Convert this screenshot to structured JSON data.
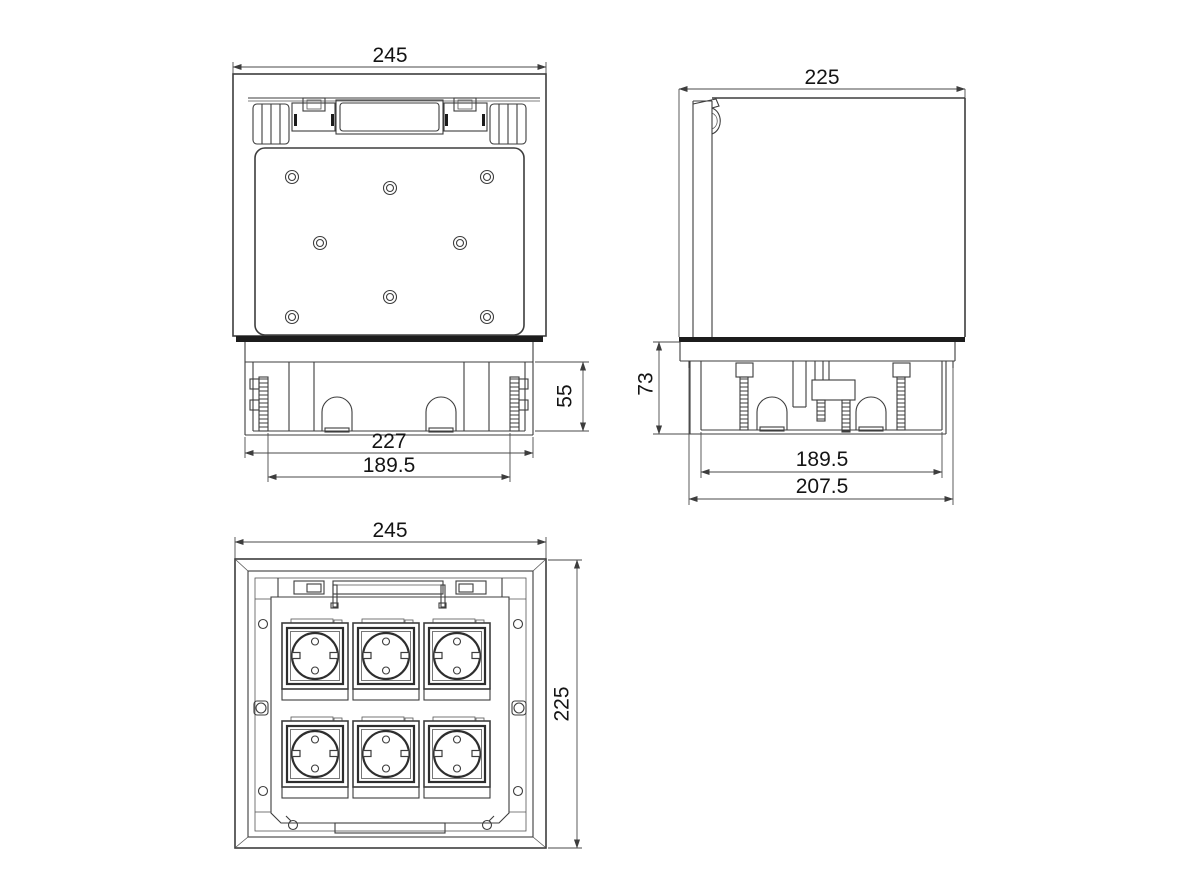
{
  "drawing": {
    "background": "#ffffff",
    "line_color": "#3d3d3d",
    "text_color": "#141414",
    "views": {
      "front": {
        "overall_width": "245",
        "box_width": "227",
        "stud_spacing": "189.5",
        "box_depth": "55"
      },
      "side": {
        "overall_width": "225",
        "box_depth": "73",
        "inner_width": "189.5",
        "flange_width": "207.5"
      },
      "plan": {
        "overall_width": "245",
        "overall_height": "225"
      }
    }
  }
}
